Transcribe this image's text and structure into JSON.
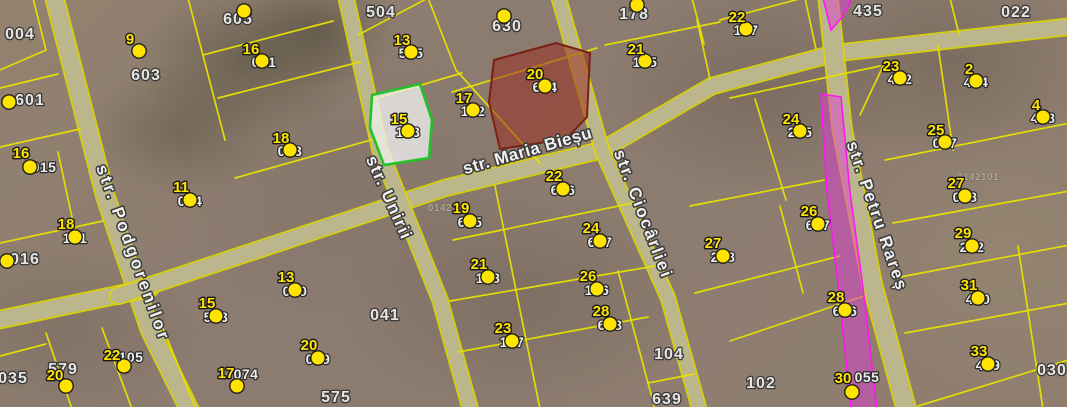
{
  "map": {
    "width": 1067,
    "height": 407,
    "colors": {
      "parcel_line": "#e8e000",
      "road_fill": "#b9b493",
      "road_edge": "#ded800",
      "dot_fill": "#ffe400",
      "dot_stroke": "#1f1f1f",
      "green_parcel_stroke": "#22c32a",
      "green_parcel_fill": "rgba(240,240,238,0.78)",
      "red_parcel_stroke": "#7a2015",
      "red_parcel_fill": "rgba(155,47,34,0.55)",
      "magenta_stroke": "#ff17f0",
      "magenta_fill": "rgba(222,62,214,0.5)"
    },
    "streets": [
      {
        "name": "str. Podgorenilor",
        "x": 128,
        "y": 255,
        "rotate": 70,
        "spacing": 3
      },
      {
        "name": "str. Unirii",
        "x": 384,
        "y": 200,
        "rotate": 66,
        "spacing": 1.5
      },
      {
        "name": "str. Maria Bieșu",
        "x": 529,
        "y": 156,
        "rotate": -16,
        "spacing": 0.5
      },
      {
        "name": "str. Ciocârliei",
        "x": 638,
        "y": 216,
        "rotate": 69,
        "spacing": 2
      },
      {
        "name": "str. Petru Rareș",
        "x": 872,
        "y": 218,
        "rotate": 71,
        "spacing": 2
      }
    ],
    "roads": [
      {
        "d": "M52,-12 L105,195 L150,330 L192,415",
        "w": 17
      },
      {
        "d": "M-12,322 L150,288",
        "w": 16
      },
      {
        "d": "M118,296 L445,188 L602,150 L712,86 L836,53 L1075,26",
        "w": 15
      },
      {
        "d": "M344,-12 L380,150 L440,300 L472,415",
        "w": 14
      },
      {
        "d": "M556,-12 L602,150 L668,298 L701,415",
        "w": 13
      },
      {
        "d": "M827,-12 L842,128 L872,283 L908,415",
        "w": 18
      }
    ],
    "parcel_lines": [
      "M33,-2 L46,50 L0,70",
      "M0,88 L58,74",
      "M0,147 L80,129",
      "M0,243 L103,221",
      "M58,152 L76,236",
      "M0,356 L46,344",
      "M46,333 L72,409",
      "M102,328 L132,409",
      "M160,321 L196,409",
      "M188,-2 L225,140",
      "M203,55 L333,21",
      "M218,98 L360,62",
      "M235,178 L385,136",
      "M358,35 L428,-2",
      "M428,-2 L456,70 L540,163",
      "M374,99 L462,73",
      "M452,92 L597,48",
      "M453,240 L633,203",
      "M495,186 L540,409",
      "M450,301 L655,266",
      "M458,352 L648,317",
      "M618,271 L655,409",
      "M648,383 L694,374",
      "M692,-2 L704,44",
      "M720,20 L803,-2",
      "M605,45 L720,22",
      "M697,20 L710,79",
      "M805,-2 L816,49",
      "M730,98 L880,66",
      "M755,99 L786,200",
      "M690,206 L824,180",
      "M695,293 L840,256",
      "M780,206 L803,293",
      "M730,341 L864,296",
      "M950,-2 L959,34",
      "M938,46 L953,150",
      "M885,160 L1075,122",
      "M893,223 L1075,190",
      "M900,277 L1075,244",
      "M905,333 L1075,302",
      "M918,406 L1075,358",
      "M1018,246 L1043,409",
      "M860,115 L885,62"
    ],
    "magenta_segments": [
      {
        "points": "823,-2 853,-2 842,17 831,30"
      },
      {
        "points": "821,94 841,97 850,192 863,288 877,409 851,409 839,293 827,192"
      }
    ],
    "highlights": [
      {
        "id": "green",
        "points": "372,95 420,84 432,120 429,158 384,165 370,128"
      },
      {
        "id": "red",
        "points": "494,60 556,43 590,53 587,117 566,139 500,149 489,102"
      }
    ],
    "block_labels": [
      {
        "text": "004",
        "x": 20,
        "y": 39
      },
      {
        "text": "603",
        "x": 146,
        "y": 80
      },
      {
        "text": "605",
        "x": 238,
        "y": 24
      },
      {
        "text": "601",
        "x": 30,
        "y": 105
      },
      {
        "text": "016",
        "x": 25,
        "y": 264
      },
      {
        "text": "035",
        "x": 13,
        "y": 383
      },
      {
        "text": "579",
        "x": 63,
        "y": 374
      },
      {
        "text": "575",
        "x": 336,
        "y": 402
      },
      {
        "text": "041",
        "x": 385,
        "y": 320
      },
      {
        "text": "504",
        "x": 381,
        "y": 17
      },
      {
        "text": "630",
        "x": 507,
        "y": 31
      },
      {
        "text": "178",
        "x": 634,
        "y": 19
      },
      {
        "text": "435",
        "x": 868,
        "y": 16
      },
      {
        "text": "022",
        "x": 1016,
        "y": 17
      },
      {
        "text": "104",
        "x": 669,
        "y": 359
      },
      {
        "text": "639",
        "x": 667,
        "y": 404
      },
      {
        "text": "102",
        "x": 761,
        "y": 388
      },
      {
        "text": "030",
        "x": 1052,
        "y": 375
      }
    ],
    "faint_labels": [
      {
        "text": "0142",
        "x": 440,
        "y": 211
      },
      {
        "text": "0142101",
        "x": 978,
        "y": 180
      }
    ],
    "points": [
      {
        "num": "9",
        "tag": "",
        "x": 139,
        "y": 51,
        "nx": 130,
        "ny": 44
      },
      {
        "num": "13",
        "tag": "505",
        "x": 411,
        "y": 52,
        "nx": 402,
        "ny": 45,
        "tx": 411,
        "ty": 58
      },
      {
        "num": "16",
        "tag": "001",
        "x": 262,
        "y": 61,
        "nx": 251,
        "ny": 54,
        "tx": 264,
        "ty": 67
      },
      {
        "num": "20",
        "tag": "604",
        "x": 545,
        "y": 86,
        "nx": 535,
        "ny": 79,
        "tx": 545,
        "ty": 92
      },
      {
        "num": "17",
        "tag": "102",
        "x": 473,
        "y": 110,
        "nx": 464,
        "ny": 103,
        "tx": 473,
        "ty": 116
      },
      {
        "num": "15",
        "tag": "103",
        "x": 408,
        "y": 131,
        "nx": 399,
        "ny": 124,
        "tx": 408,
        "ty": 137
      },
      {
        "num": "21",
        "tag": "105",
        "x": 645,
        "y": 61,
        "nx": 636,
        "ny": 54,
        "tx": 645,
        "ty": 67
      },
      {
        "num": "22",
        "tag": "107",
        "x": 746,
        "y": 29,
        "nx": 737,
        "ny": 22,
        "tx": 746,
        "ty": 35
      },
      {
        "num": "23",
        "tag": "402",
        "x": 900,
        "y": 78,
        "nx": 891,
        "ny": 71,
        "tx": 900,
        "ty": 84
      },
      {
        "num": "2",
        "tag": "404",
        "x": 976,
        "y": 81,
        "nx": 969,
        "ny": 74,
        "tx": 976,
        "ty": 87
      },
      {
        "num": "4",
        "tag": "408",
        "x": 1043,
        "y": 117,
        "nx": 1036,
        "ny": 110,
        "tx": 1043,
        "ty": 123
      },
      {
        "num": "24",
        "tag": "205",
        "x": 800,
        "y": 131,
        "nx": 791,
        "ny": 124,
        "tx": 800,
        "ty": 137
      },
      {
        "num": "25",
        "tag": "007",
        "x": 945,
        "y": 142,
        "nx": 936,
        "ny": 135,
        "tx": 945,
        "ty": 148
      },
      {
        "num": "18",
        "tag": "003",
        "x": 290,
        "y": 150,
        "nx": 281,
        "ny": 143,
        "tx": 290,
        "ty": 156
      },
      {
        "num": "16",
        "tag": "015",
        "x": 30,
        "y": 167,
        "nx": 21,
        "ny": 158,
        "tx": 44,
        "ty": 172
      },
      {
        "num": "11",
        "tag": "004",
        "x": 190,
        "y": 200,
        "nx": 181,
        "ny": 192,
        "tx": 190,
        "ty": 206
      },
      {
        "num": "18",
        "tag": "101",
        "x": 75,
        "y": 237,
        "nx": 66,
        "ny": 229,
        "tx": 75,
        "ty": 243
      },
      {
        "num": "19",
        "tag": "605",
        "x": 470,
        "y": 221,
        "nx": 461,
        "ny": 213,
        "tx": 470,
        "ty": 227
      },
      {
        "num": "22",
        "tag": "606",
        "x": 563,
        "y": 189,
        "nx": 554,
        "ny": 181,
        "tx": 563,
        "ty": 195
      },
      {
        "num": "24",
        "tag": "607",
        "x": 600,
        "y": 241,
        "nx": 591,
        "ny": 233,
        "tx": 600,
        "ty": 247
      },
      {
        "num": "26",
        "tag": "607",
        "x": 818,
        "y": 224,
        "nx": 809,
        "ny": 216,
        "tx": 818,
        "ty": 230
      },
      {
        "num": "27",
        "tag": "208",
        "x": 723,
        "y": 256,
        "nx": 713,
        "ny": 248,
        "tx": 723,
        "ty": 262
      },
      {
        "num": "27",
        "tag": "008",
        "x": 965,
        "y": 196,
        "nx": 956,
        "ny": 188,
        "tx": 965,
        "ty": 202
      },
      {
        "num": "29",
        "tag": "202",
        "x": 972,
        "y": 246,
        "nx": 963,
        "ny": 238,
        "tx": 972,
        "ty": 252
      },
      {
        "num": "26",
        "tag": "106",
        "x": 597,
        "y": 289,
        "nx": 588,
        "ny": 281,
        "tx": 597,
        "ty": 295
      },
      {
        "num": "28",
        "tag": "608",
        "x": 610,
        "y": 324,
        "nx": 601,
        "ny": 316,
        "tx": 610,
        "ty": 330
      },
      {
        "num": "21",
        "tag": "108",
        "x": 488,
        "y": 277,
        "nx": 479,
        "ny": 269,
        "tx": 488,
        "ty": 283
      },
      {
        "num": "23",
        "tag": "107",
        "x": 512,
        "y": 341,
        "nx": 503,
        "ny": 333,
        "tx": 512,
        "ty": 347
      },
      {
        "num": "13",
        "tag": "000",
        "x": 295,
        "y": 290,
        "nx": 286,
        "ny": 282,
        "tx": 295,
        "ty": 296
      },
      {
        "num": "15",
        "tag": "503",
        "x": 216,
        "y": 316,
        "nx": 207,
        "ny": 308,
        "tx": 216,
        "ty": 322
      },
      {
        "num": "17",
        "tag": "074",
        "x": 237,
        "y": 386,
        "nx": 226,
        "ny": 378,
        "tx": 246,
        "ty": 379
      },
      {
        "num": "20",
        "tag": "009",
        "x": 318,
        "y": 358,
        "nx": 309,
        "ny": 350,
        "tx": 318,
        "ty": 364
      },
      {
        "num": "20",
        "tag": "",
        "x": 66,
        "y": 386,
        "nx": 55,
        "ny": 380
      },
      {
        "num": "22",
        "tag": "105",
        "x": 124,
        "y": 366,
        "nx": 112,
        "ny": 360,
        "tx": 131,
        "ty": 362
      },
      {
        "num": "28",
        "tag": "606",
        "x": 845,
        "y": 310,
        "nx": 836,
        "ny": 302,
        "tx": 845,
        "ty": 316
      },
      {
        "num": "30",
        "tag": "055",
        "x": 852,
        "y": 392,
        "nx": 843,
        "ny": 383,
        "tx": 867,
        "ty": 382
      },
      {
        "num": "31",
        "tag": "400",
        "x": 978,
        "y": 298,
        "nx": 969,
        "ny": 290,
        "tx": 978,
        "ty": 304
      },
      {
        "num": "33",
        "tag": "409",
        "x": 988,
        "y": 364,
        "nx": 979,
        "ny": 356,
        "tx": 988,
        "ty": 370
      },
      {
        "num": "",
        "tag": "",
        "x": 244,
        "y": 11
      },
      {
        "num": "",
        "tag": "",
        "x": 504,
        "y": 16
      },
      {
        "num": "",
        "tag": "",
        "x": 637,
        "y": 5
      },
      {
        "num": "",
        "tag": "",
        "x": 9,
        "y": 102
      },
      {
        "num": "",
        "tag": "",
        "x": 7,
        "y": 261
      }
    ]
  }
}
